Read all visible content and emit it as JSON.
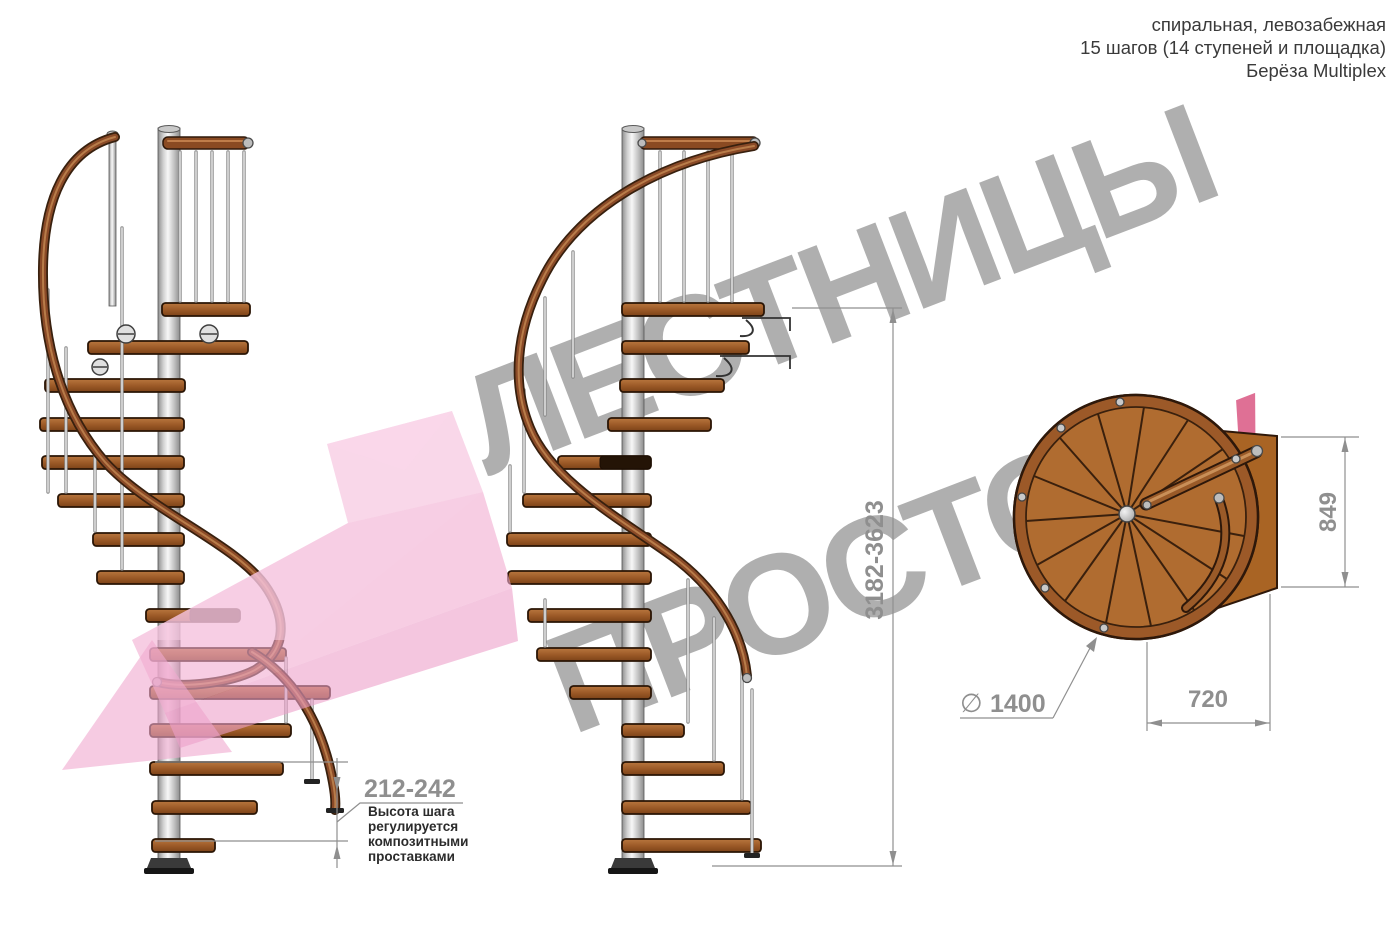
{
  "header": {
    "line1": "спиральная, левозабежная",
    "line2": "15 шагов (14 ступеней и площадка)",
    "line3": "Берёза Multiplex"
  },
  "watermark": {
    "line1": "ЛЕСТНИЦЫ",
    "line2_gray": "ПРОСТО",
    "line2_pink": ".ру"
  },
  "dimensions": {
    "total_height": "3182-3623",
    "step_height": "212-242",
    "landing_depth": "849",
    "tread_span": "720",
    "diameter_symbol": "∅",
    "diameter_value": "1400"
  },
  "annotation": {
    "line1": "Высота шага",
    "line2": "регулируется",
    "line3": "композитными",
    "line4": "проставками"
  },
  "colors": {
    "watermark_gray": "#9e9e9e",
    "watermark_pink": "#d9517e",
    "arrow_pink": "#f1abd0",
    "tread_wood": "#9a5826",
    "rail_wood": "#8a4a27",
    "plan_wood": "#b06c30",
    "metal_pole": "#cfcfcf",
    "dimension_gray": "#8f8f8f",
    "note_text": "#2b2b2b"
  }
}
